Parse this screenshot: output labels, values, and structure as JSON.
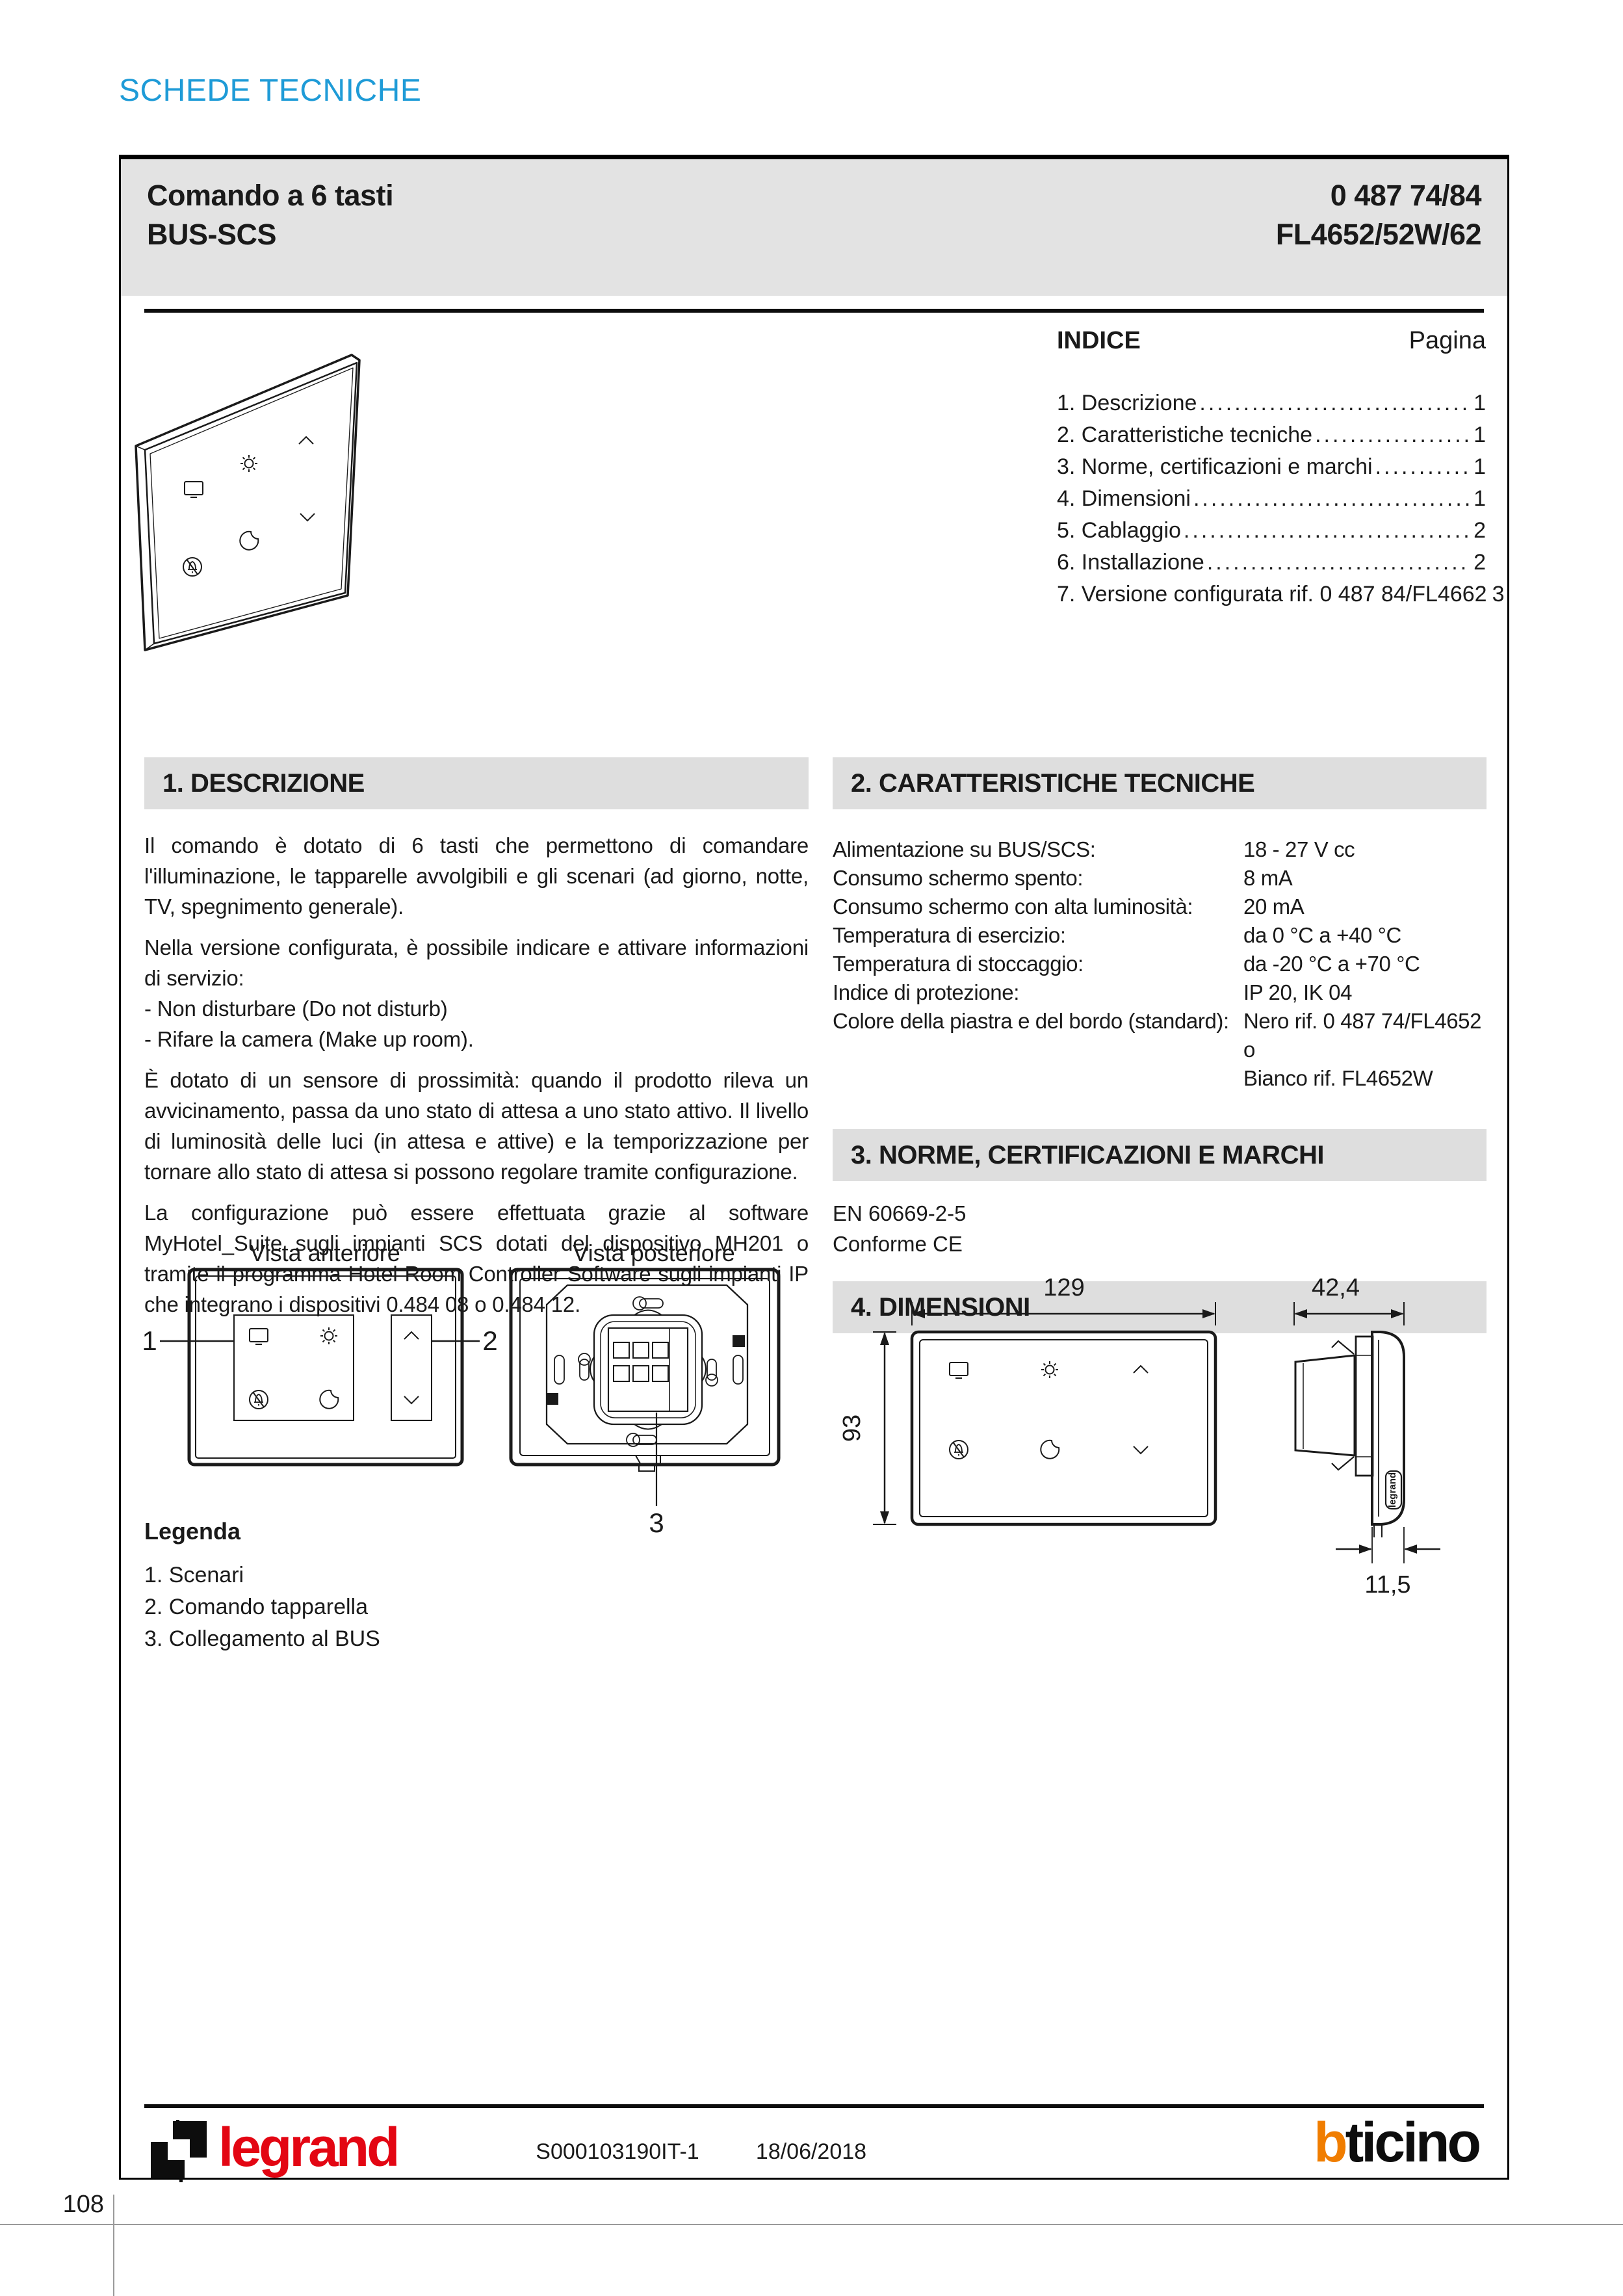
{
  "page": {
    "eyebrow": "SCHEDE TECNICHE",
    "page_number": "108"
  },
  "header": {
    "title_line1": "Comando a 6 tasti",
    "title_line2": "BUS-SCS",
    "code_line1": "0 487 74/84",
    "code_line2": "FL4652/52W/62"
  },
  "toc": {
    "title": "INDICE",
    "page_label": "Pagina",
    "items": [
      {
        "label": "1. Descrizione",
        "page": "1"
      },
      {
        "label": "2. Caratteristiche tecniche",
        "page": "1"
      },
      {
        "label": "3. Norme, certificazioni e marchi",
        "page": "1"
      },
      {
        "label": "4. Dimensioni",
        "page": "1"
      },
      {
        "label": "5. Cablaggio",
        "page": "2"
      },
      {
        "label": "6. Installazione",
        "page": "2"
      },
      {
        "label": "7. Versione configurata rif. 0 487 84/FL4662",
        "page": "3"
      }
    ]
  },
  "descrizione": {
    "title": "1. DESCRIZIONE",
    "p1": "Il comando è dotato di 6 tasti che permettono di comandare l'illuminazione, le tapparelle avvolgibili e gli scenari (ad giorno, notte, TV, spegnimento generale).",
    "p2": "Nella versione configurata, è possibile indicare e attivare informazioni di servizio:",
    "li1": "- Non disturbare (Do not disturb)",
    "li2": "- Rifare la camera (Make up room).",
    "p3": "È dotato di un sensore di prossimità: quando il prodotto rileva un avvicinamento, passa da uno stato di attesa a uno stato attivo. Il livello di luminosità delle luci (in attesa e attive) e la temporizzazione per tornare allo stato di attesa si possono regolare tramite configurazione.",
    "p4": "La configurazione può essere effettuata grazie al software MyHotel_Suite sugli impianti SCS dotati del dispositivo MH201 o tramite il programma Hotel Room Controller Software sugli impianti IP che integrano i dispositivi 0.484 08 o 0.484 12."
  },
  "caratteristiche": {
    "title": "2. CARATTERISTICHE TECNICHE",
    "rows": [
      {
        "label": "Alimentazione su BUS/SCS:",
        "value": "18 - 27 V cc"
      },
      {
        "label": "Consumo schermo spento:",
        "value": "8 mA"
      },
      {
        "label": "Consumo schermo con alta luminosità:",
        "value": "20 mA"
      },
      {
        "label": "Temperatura di esercizio:",
        "value": "da 0 °C a +40 °C"
      },
      {
        "label": "Temperatura di stoccaggio:",
        "value": "da -20 °C a +70 °C"
      },
      {
        "label": "Indice di protezione:",
        "value": "IP 20, IK 04"
      },
      {
        "label": "Colore della piastra e del bordo (standard):",
        "value": "Nero rif. 0 487 74/FL4652 o",
        "value2": "Bianco rif. FL4652W"
      }
    ]
  },
  "norme": {
    "title": "3. NORME, CERTIFICAZIONI E MARCHI",
    "line1": "EN 60669-2-5",
    "line2": "Conforme CE"
  },
  "dimensioni": {
    "title": "4. DIMENSIONI",
    "width_mm": "129",
    "height_mm": "93",
    "depth_mm": "42,4",
    "plate_mm": "11,5",
    "side_logo": "legrand"
  },
  "views": {
    "front_label": "Vista anteriore",
    "rear_label": "Vista posteriore",
    "callout_1": "1",
    "callout_2": "2",
    "callout_3": "3"
  },
  "legenda": {
    "title": "Legenda",
    "items": [
      "1. Scenari",
      "2. Comando tapparella",
      "3. Collegamento al BUS"
    ]
  },
  "footer": {
    "doc_ref": "S000103190IT-1",
    "date": "18/06/2018",
    "brand_left": "legrand",
    "brand_right_b": "b",
    "brand_right_rest": "ticino"
  },
  "colors": {
    "accent_blue": "#1e9bd7",
    "legrand_red": "#e30613",
    "bticino_orange": "#f07d00",
    "header_gray": "#e3e3e3",
    "section_bar_gray": "#dedede"
  }
}
